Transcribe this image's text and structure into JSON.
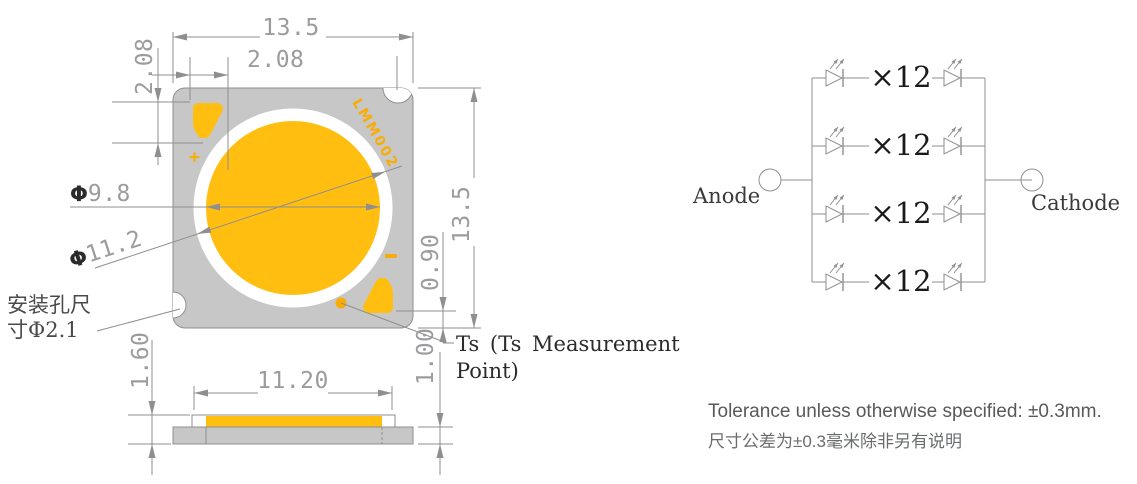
{
  "colors": {
    "phosphor_orange": "#FFBE10",
    "mark_orange": "#F7AC08",
    "package_gray": "#C7C7C8",
    "line_gray": "#8F8F8F",
    "dim_text_gray": "#9A9C9E",
    "dark_text": "#2B2B2B",
    "tolerance_text": "#58595B"
  },
  "top_view": {
    "marking": "LMM002",
    "plus_mark": "+",
    "dim_overall_width": "13.5",
    "dim_pad_width": "2.08",
    "dim_pad_height": "2.08",
    "dia_symbol": "Φ",
    "dim_emitting_dia": "9.8",
    "dim_dam_dia": "11.2",
    "dim_overall_height": "13.5",
    "dim_pad_to_edge": "0.90",
    "mount_note_line1": "安装孔尺",
    "mount_note_line2": "寸Φ2.1",
    "ts_note_line1": "Ts (Ts Measurement",
    "ts_note_line2": "Point)"
  },
  "side_view": {
    "dim_total_thickness": "1.60",
    "dim_les_width": "11.20",
    "dim_substrate_thickness": "1.00"
  },
  "circuit": {
    "anode_label": "Anode",
    "cathode_label": "Cathode",
    "branch_label": "×12",
    "branch_count": 4,
    "leds_per_branch": 12
  },
  "notes": {
    "tolerance_en": "Tolerance unless otherwise specified: ±0.3mm.",
    "tolerance_zh": "尺寸公差为±0.3毫米除非另有说明"
  }
}
